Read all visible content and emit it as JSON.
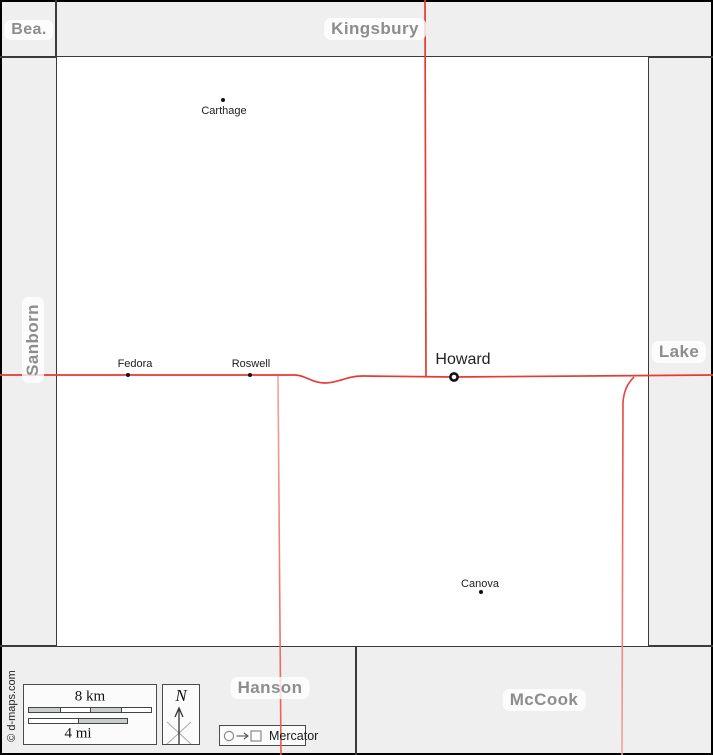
{
  "map_type": "county-map",
  "neighbor_labels": {
    "top_left": "Bea.",
    "top": "Kingsbury",
    "left": "Sanborn",
    "right": "Lake",
    "bottom_left": "Hanson",
    "bottom_right": "McCook"
  },
  "towns": {
    "carthage": {
      "name": "Carthage",
      "marker": "dot"
    },
    "fedora": {
      "name": "Fedora",
      "marker": "dot"
    },
    "roswell": {
      "name": "Roswell",
      "marker": "dot"
    },
    "howard": {
      "name": "Howard",
      "marker": "county-seat-ring"
    },
    "canova": {
      "name": "Canova",
      "marker": "dot"
    }
  },
  "legend": {
    "km_label": "8 km",
    "mi_label": "4 mi",
    "north_label": "N",
    "projection_label": "Mercator"
  },
  "credit": "© d-maps.com",
  "colors": {
    "margin_bg": "#efefef",
    "county_fill": "#ffffff",
    "boundary": "#3a3a3a",
    "frame": "#000000",
    "county_label": "#8d8d8d",
    "road_primary": "#e63a32",
    "road_secondary": "#f0837c",
    "scale_bar_gray": "#c9cccc"
  }
}
